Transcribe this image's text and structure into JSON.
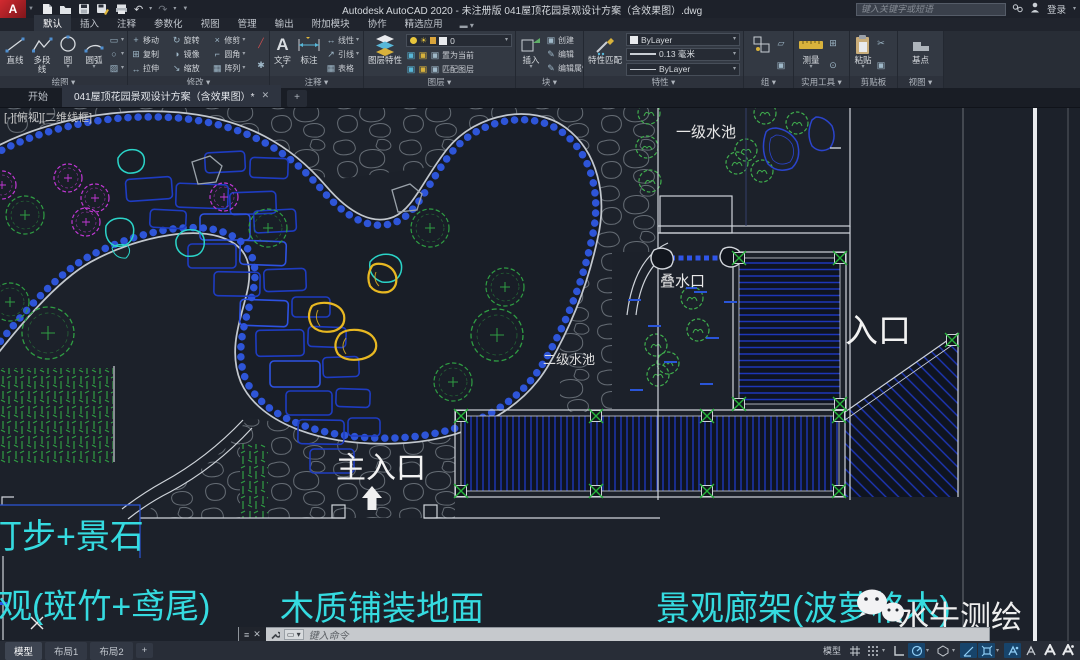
{
  "titlebar": {
    "title": "Autodesk AutoCAD 2020 - 未注册版   041屋顶花园景观设计方案（含效果图）.dwg",
    "search_placeholder": "键入关键字或短语",
    "signin": "登录"
  },
  "ribbon": {
    "tabs": [
      {
        "label": "默认"
      },
      {
        "label": "插入"
      },
      {
        "label": "注释"
      },
      {
        "label": "参数化"
      },
      {
        "label": "视图"
      },
      {
        "label": "管理"
      },
      {
        "label": "输出"
      },
      {
        "label": "附加模块"
      },
      {
        "label": "协作"
      },
      {
        "label": "精选应用"
      }
    ],
    "draw": {
      "label": "绘图",
      "tools": [
        "直线",
        "多段线",
        "圆",
        "圆弧"
      ]
    },
    "modify": {
      "label": "修改",
      "tools": [
        "移动",
        "旋转",
        "修剪",
        "复制",
        "镜像",
        "圆角",
        "拉伸",
        "缩放",
        "阵列"
      ]
    },
    "annotate": {
      "label": "注释",
      "text": "文字",
      "dim": "标注",
      "tools": [
        "线性",
        "引线",
        "表格"
      ]
    },
    "layers": {
      "label": "图层",
      "big": "图层特性",
      "current_layer": "0",
      "make_current": "置为当前",
      "match": "匹配图层"
    },
    "block": {
      "label": "块",
      "insert": "插入",
      "tools": [
        "创建",
        "编辑",
        "编辑属性"
      ]
    },
    "properties": {
      "label": "特性",
      "big": "特性匹配",
      "color": "ByLayer",
      "lineweight": "0.13 毫米",
      "linetype": "ByLayer"
    },
    "group": {
      "label": "组"
    },
    "utilities": {
      "label": "实用工具",
      "measure": "测量"
    },
    "clipboard": {
      "label": "剪贴板",
      "paste": "粘贴"
    },
    "view": {
      "label": "视图",
      "base": "基点"
    }
  },
  "doctabs": {
    "start": "开始",
    "doc": "041屋顶花园景观设计方案（含效果图）*",
    "close": "✕",
    "add": "+"
  },
  "canvas": {
    "viewport_label": "[-][俯视][二维线框]",
    "labels": {
      "pool1": "一级水池",
      "pool2": "二级水池",
      "cascade": "叠水口",
      "main_entrance": "主入口",
      "entrance": "入口",
      "stepping": "汀步+景石",
      "bamboo": "景观(斑竹+鸢尾)",
      "wood_floor": "木质铺装地面",
      "pergola": "景观廊架(波萝格木)",
      "watermark": "水牛测绘"
    }
  },
  "cmd": {
    "placeholder": "键入命令"
  },
  "statusbar": {
    "model_tab": "模型",
    "layout1": "布局1",
    "layout2": "布局2",
    "add_layout": "+",
    "model_label": "模型",
    "icons": [
      {
        "name": "grid-icon",
        "active": false
      },
      {
        "name": "snap-icon",
        "active": false
      },
      {
        "name": "ortho-icon",
        "active": false
      },
      {
        "name": "polar-tracking-icon",
        "active": true
      },
      {
        "name": "isodraft-icon",
        "active": false
      },
      {
        "name": "otrack-icon",
        "active": true
      },
      {
        "name": "osnap-icon",
        "active": true
      },
      {
        "name": "annotation-icon",
        "active": true
      },
      {
        "name": "annotation-scale-icon",
        "active": false
      }
    ]
  },
  "colors": {
    "canvas_bg": "#1c212a",
    "cyan_label": "#35dbe0",
    "pond_edge_blue": "#2e55d8",
    "stepping_stone_blue": "#1e3cc2",
    "stone_gray": "#656c74",
    "tree_green": "#2f9e43",
    "flower_magenta": "#c238d6",
    "rock_yellow": "#e8b822",
    "white_line": "#cfd4da"
  }
}
